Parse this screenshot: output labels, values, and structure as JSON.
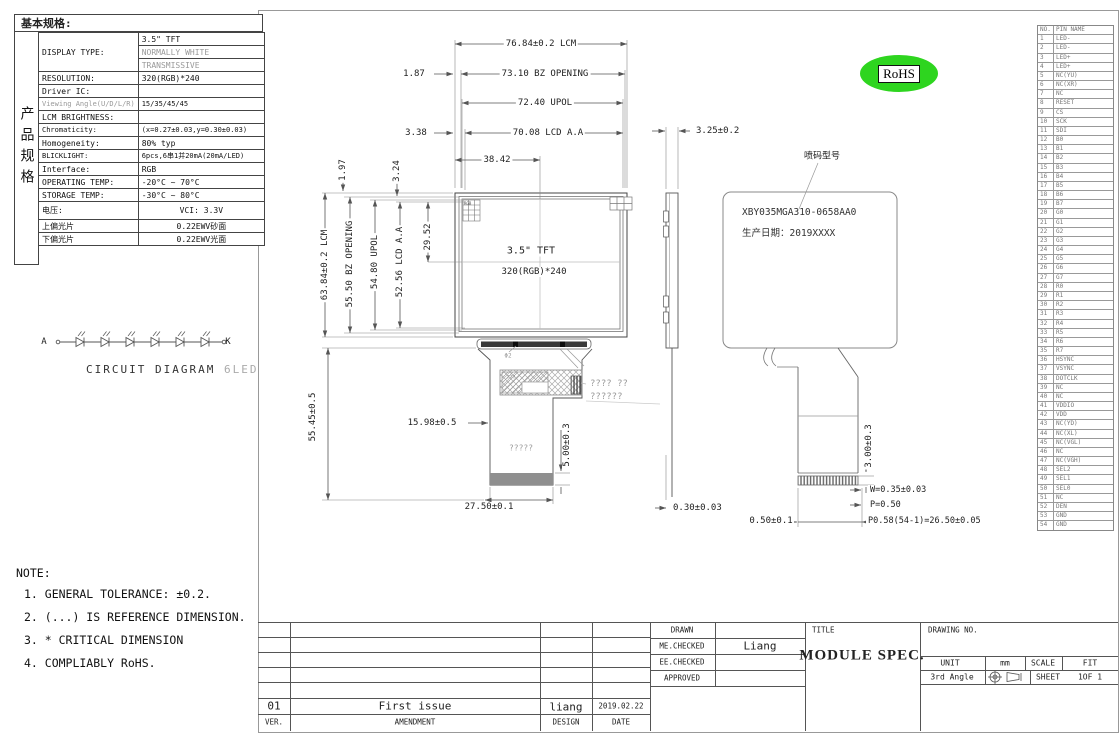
{
  "spec_table": {
    "title": "基本规格:",
    "side_label": "产品规格",
    "rows": [
      {
        "label": "DISPLAY TYPE:",
        "span": 3,
        "value": "3.5\" TFT"
      },
      {
        "value": "NORMALLY WHITE",
        "mv": true
      },
      {
        "value": "TRANSMISSIVE",
        "mv": true
      },
      {
        "label": "RESOLUTION:",
        "value": "320(RGB)*240"
      },
      {
        "label": "Driver IC:",
        "value": ""
      },
      {
        "label": "Viewing Angle(U/D/L/R)",
        "value": "15/35/45/45",
        "ml": true,
        "small": true
      },
      {
        "label": "LCM BRIGHTNESS:",
        "value": ""
      },
      {
        "label": "Chromaticity:",
        "value": "(x=0.27±0.03,y=0.30±0.03)",
        "small": true
      },
      {
        "label": "Homogeneity:",
        "value": "80% typ"
      },
      {
        "label": "BLICKLIGHT:",
        "value": "6pcs,6串1并20mA(20mA/LED)",
        "small": true
      },
      {
        "label": "Interface:",
        "value": "RGB"
      },
      {
        "label": "OPERATING TEMP:",
        "value": "-20°C ~ 70°C"
      },
      {
        "label": "STORAGE TEMP:",
        "value": "-30°C ~ 80°C"
      },
      {
        "label": "电压:",
        "value": "VCI: 3.3V",
        "tall": true,
        "center": true
      },
      {
        "label": "上偏光片",
        "value": "0.22EWV砂面",
        "center": true
      },
      {
        "label": "下偏光片",
        "value": "0.22EWV光面",
        "center": true
      }
    ]
  },
  "circuit": {
    "label_a": "A",
    "label_k": "K",
    "title": "CIRCUIT DIAGRAM",
    "led_count_label": "6LED",
    "led_count": 6
  },
  "notes": {
    "title": "NOTE:",
    "items": [
      "1. GENERAL TOLERANCE: ±0.2.",
      "2. (...) IS REFERENCE DIMENSION.",
      "3. * CRITICAL DIMENSION",
      "4. COMPLIABLY RoHS."
    ]
  },
  "front_view": {
    "screen_line1": "3.5\" TFT",
    "screen_line2": "320(RGB)*240",
    "rgb_label": "RGB",
    "dims": {
      "lcm_w": "76.84±0.2  LCM",
      "bz_w": "73.10  BZ OPENING",
      "upol_w": "72.40  UPOL",
      "aa_w": "70.08  LCD A.A",
      "half_w": "38.42",
      "off1": "1.87",
      "off2": "3.38",
      "off3": "1.97",
      "off4": "3.24",
      "lcm_h": "63.84±0.2  LCM",
      "bz_h": "55.50  BZ OPENING",
      "upol_h": "54.80  UPOL",
      "aa_h": "52.56  LCD A.A",
      "half_h": "29.52",
      "tail_h": "55.45±0.5",
      "tail_top": "15.98±0.5",
      "tail_conn_h": "5.00±0.3",
      "tail_w": "27.50±0.1",
      "hole": "Φ2"
    },
    "flex_note_line1": "????    ??",
    "flex_note_line2": "??????",
    "flex_label": "?????",
    "stiffener_label": "???"
  },
  "side_view": {
    "thickness": "3.25±0.2",
    "bottom_offset": "0.30±0.03"
  },
  "back_view": {
    "callout": "喷码型号",
    "label_line1": "XBY035MGA310-0658AA0",
    "label_line2": "生产日期：2019XXXX",
    "dims": {
      "conn_h": "3.00±0.3",
      "pad_w": "W=0.35±0.03",
      "pitch": "P=0.50",
      "total_pitch": "P0.58(54-1)=26.50±0.05",
      "edge": "0.50±0.1"
    }
  },
  "rohs": {
    "label": "RoHS"
  },
  "pin_table": {
    "headers": [
      "NO.",
      "PIN NAME"
    ],
    "pins": [
      {
        "no": "1",
        "name": "LED-"
      },
      {
        "no": "2",
        "name": "LED-"
      },
      {
        "no": "3",
        "name": "LED+"
      },
      {
        "no": "4",
        "name": "LED+"
      },
      {
        "no": "5",
        "name": "NC(YU)"
      },
      {
        "no": "6",
        "name": "NC(XR)"
      },
      {
        "no": "7",
        "name": "NC"
      },
      {
        "no": "8",
        "name": "RESET"
      },
      {
        "no": "9",
        "name": "CS"
      },
      {
        "no": "10",
        "name": "SCK"
      },
      {
        "no": "11",
        "name": "SDI"
      },
      {
        "no": "12",
        "name": "B0"
      },
      {
        "no": "13",
        "name": "B1"
      },
      {
        "no": "14",
        "name": "B2"
      },
      {
        "no": "15",
        "name": "B3"
      },
      {
        "no": "16",
        "name": "B4"
      },
      {
        "no": "17",
        "name": "B5"
      },
      {
        "no": "18",
        "name": "B6"
      },
      {
        "no": "19",
        "name": "B7"
      },
      {
        "no": "20",
        "name": "G0"
      },
      {
        "no": "21",
        "name": "G1"
      },
      {
        "no": "22",
        "name": "G2"
      },
      {
        "no": "23",
        "name": "G3"
      },
      {
        "no": "24",
        "name": "G4"
      },
      {
        "no": "25",
        "name": "G5"
      },
      {
        "no": "26",
        "name": "G6"
      },
      {
        "no": "27",
        "name": "G7"
      },
      {
        "no": "28",
        "name": "R0"
      },
      {
        "no": "29",
        "name": "R1"
      },
      {
        "no": "30",
        "name": "R2"
      },
      {
        "no": "31",
        "name": "R3"
      },
      {
        "no": "32",
        "name": "R4"
      },
      {
        "no": "33",
        "name": "R5"
      },
      {
        "no": "34",
        "name": "R6"
      },
      {
        "no": "35",
        "name": "R7"
      },
      {
        "no": "36",
        "name": "HSYNC"
      },
      {
        "no": "37",
        "name": "VSYNC"
      },
      {
        "no": "38",
        "name": "DOTCLK"
      },
      {
        "no": "39",
        "name": "NC"
      },
      {
        "no": "40",
        "name": "NC"
      },
      {
        "no": "41",
        "name": "VDDIO"
      },
      {
        "no": "42",
        "name": "VDD"
      },
      {
        "no": "43",
        "name": "NC(YD)"
      },
      {
        "no": "44",
        "name": "NC(XL)"
      },
      {
        "no": "45",
        "name": "NC(VGL)"
      },
      {
        "no": "46",
        "name": "NC"
      },
      {
        "no": "47",
        "name": "NC(VGH)"
      },
      {
        "no": "48",
        "name": "SEL2"
      },
      {
        "no": "49",
        "name": "SEL1"
      },
      {
        "no": "50",
        "name": "SEL0"
      },
      {
        "no": "51",
        "name": "NC"
      },
      {
        "no": "52",
        "name": "DEN"
      },
      {
        "no": "53",
        "name": "GND"
      },
      {
        "no": "54",
        "name": "GND"
      }
    ]
  },
  "title_block": {
    "drawn_label": "DRAWN",
    "drawn_value": "",
    "me_checked_label": "ME.CHECKED",
    "me_checked_value": "Liang",
    "ee_checked_label": "EE.CHECKED",
    "ee_checked_value": "",
    "approved_label": "APPROVED",
    "approved_value": "",
    "title_label": "TITLE",
    "title_value": "MODULE SPEC.",
    "drawing_no_label": "DRAWING NO.",
    "drawing_no_value": "",
    "unit_label": "UNIT",
    "unit_value": "mm",
    "scale_label": "SCALE",
    "scale_value": "FIT",
    "angle_label": "3rd Angle",
    "sheet_label": "SHEET",
    "sheet_value": "1OF  1"
  },
  "revision_table": {
    "rows": [
      {
        "ver": "01",
        "amendment": "First issue",
        "design": "liang",
        "date": "2019.02.22"
      }
    ],
    "footer": {
      "ver": "VER.",
      "amendment": "AMENDMENT",
      "design": "DESIGN",
      "date": "DATE"
    }
  },
  "colors": {
    "rohs_green": "#2ed51f",
    "line_dark": "#444",
    "line_dim": "#666",
    "muted_text": "#999"
  }
}
